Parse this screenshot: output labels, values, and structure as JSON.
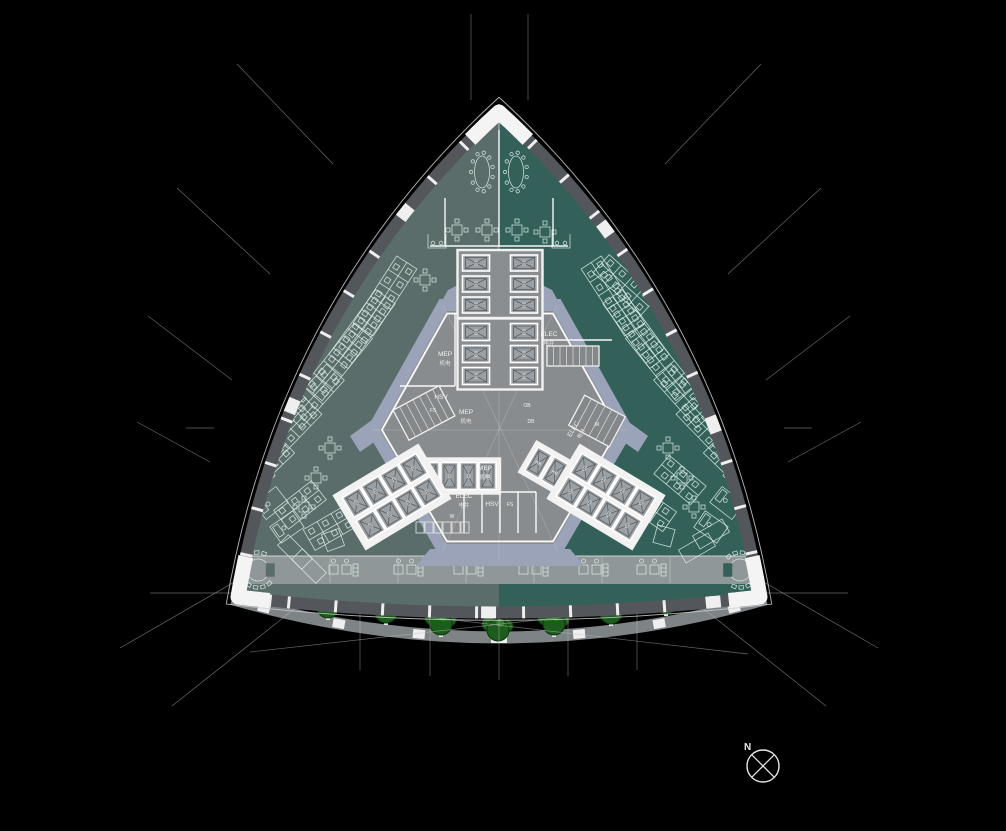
{
  "canvas": {
    "width": 1006,
    "height": 831,
    "background": "#000000"
  },
  "palette": {
    "zone_left": "#5A6D6A",
    "zone_right": "#33615A",
    "bottom_band": "#8F9798",
    "facade_dark": "#53565A",
    "facade_white": "#EFEFEF",
    "outer_line": "#CFCFCF",
    "core_ring": "#9AA3B8",
    "core_fill": "#898C8E",
    "core_wall": "#FFFFFF",
    "shaft_fill": "#9AA0A3",
    "shaft_line": "#5C5F62",
    "furniture_line": "#DFF0EA",
    "hedge_green": "#17500F",
    "tree_fill": "#1C5C1C",
    "tree_edge": "#093609",
    "tree_highlight": "#2E7D2B",
    "walkway_gray": "#7E8486",
    "dim_line": "#BFBFBF"
  },
  "building": {
    "apex": [
      499,
      112
    ],
    "corner_left": [
      238,
      597
    ],
    "corner_right": [
      760,
      597
    ],
    "ctrl_left": [
      288,
      305
    ],
    "ctrl_right": [
      710,
      305
    ],
    "ctrl_bottom": [
      499,
      628
    ],
    "zone_divider_x": 499,
    "bottom_band_y": 556,
    "bottom_band_h": 28
  },
  "core": {
    "hexagon": [
      [
        443,
        305
      ],
      [
        557,
        305
      ],
      [
        627,
        430
      ],
      [
        557,
        550
      ],
      [
        443,
        550
      ],
      [
        373,
        430
      ]
    ],
    "center": [
      500,
      428
    ],
    "ring_extensions": [
      [
        [
          438,
          308
        ],
        [
          460,
          308
        ],
        [
          460,
          284
        ],
        [
          448,
          290
        ]
      ],
      [
        [
          540,
          308
        ],
        [
          562,
          308
        ],
        [
          552,
          290
        ],
        [
          540,
          284
        ]
      ],
      [
        [
          430,
          549
        ],
        [
          570,
          549
        ],
        [
          584,
          566
        ],
        [
          416,
          566
        ]
      ],
      [
        [
          372,
          420
        ],
        [
          380,
          438
        ],
        [
          360,
          452
        ],
        [
          350,
          436
        ]
      ],
      [
        [
          626,
          420
        ],
        [
          618,
          438
        ],
        [
          638,
          452
        ],
        [
          648,
          436
        ]
      ]
    ],
    "labels": [
      {
        "t": "MEP",
        "s": "机电",
        "x": 445,
        "y": 356,
        "rot": 0
      },
      {
        "t": "MEP",
        "s": "机电",
        "x": 466,
        "y": 414,
        "rot": 0
      },
      {
        "t": "MEP",
        "s": "机电",
        "x": 485,
        "y": 470,
        "rot": 0
      },
      {
        "t": "ELEC",
        "s": "电井",
        "x": 549,
        "y": 336,
        "rot": 0
      },
      {
        "t": "ELEC",
        "s": "电井",
        "x": 575,
        "y": 430,
        "rot": -60
      },
      {
        "t": "ELEC",
        "s": "电井",
        "x": 464,
        "y": 498,
        "rot": 0
      },
      {
        "t": "HSV",
        "s": "",
        "x": 441,
        "y": 399,
        "rot": 0
      },
      {
        "t": "FS",
        "s": "",
        "x": 433,
        "y": 412,
        "rot": 0
      },
      {
        "t": "HSV",
        "s": "",
        "x": 492,
        "y": 506,
        "rot": 0
      },
      {
        "t": "FS",
        "s": "",
        "x": 510,
        "y": 506,
        "rot": 0
      },
      {
        "t": "W",
        "s": "",
        "x": 452,
        "y": 518,
        "rot": 0
      },
      {
        "t": "M",
        "s": "",
        "x": 597,
        "y": 426,
        "rot": 0
      },
      {
        "t": "OB",
        "s": "",
        "x": 527,
        "y": 407,
        "rot": 0
      },
      {
        "t": "DB",
        "s": "",
        "x": 531,
        "y": 423,
        "rot": 0
      }
    ],
    "partitions": [
      [
        455,
        314,
        455,
        386
      ],
      [
        400,
        386,
        455,
        386
      ],
      [
        543,
        314,
        543,
        340
      ],
      [
        543,
        340,
        612,
        340
      ],
      [
        448,
        492,
        536,
        492
      ],
      [
        464,
        492,
        464,
        533
      ],
      [
        482,
        492,
        482,
        533
      ],
      [
        500,
        492,
        500,
        533
      ],
      [
        518,
        492,
        518,
        533
      ],
      [
        536,
        492,
        536,
        533
      ],
      [
        499,
        130,
        499,
        246
      ],
      [
        430,
        246,
        568,
        246
      ],
      [
        445,
        198,
        445,
        246
      ],
      [
        553,
        198,
        553,
        246
      ]
    ],
    "toilet_stalls": {
      "x0": 416,
      "y": 522,
      "w": 8,
      "h": 11,
      "step": 9,
      "n": 6
    },
    "stairs": [
      {
        "x": 547,
        "y": 346,
        "w": 52,
        "h": 20,
        "rot": 0,
        "treads": 8
      },
      {
        "x": 398,
        "y": 396,
        "w": 52,
        "h": 34,
        "rot": -28,
        "treads": 7
      },
      {
        "x": 574,
        "y": 404,
        "w": 46,
        "h": 34,
        "rot": 28,
        "treads": 6
      }
    ],
    "construction_lines": [
      [
        373,
        430,
        627,
        430
      ],
      [
        443,
        305,
        557,
        550
      ],
      [
        557,
        305,
        443,
        550
      ],
      [
        499,
        120,
        499,
        560
      ]
    ]
  },
  "elevator_banks": [
    {
      "cx": 500,
      "cy": 284,
      "rot": 0,
      "cols": 2,
      "rows": 3,
      "cw": 27,
      "ch": 16,
      "gx": 21,
      "gy": 5,
      "pad": 5,
      "label": "2C",
      "surround": "#8B8E90"
    },
    {
      "cx": 500,
      "cy": 354,
      "rot": 0,
      "cols": 2,
      "rows": 3,
      "cw": 27,
      "ch": 17,
      "gx": 21,
      "gy": 5,
      "pad": 5,
      "label": "SO",
      "surround": "#8B8E90"
    },
    {
      "cx": 459,
      "cy": 476,
      "rot": 0,
      "cols": 4,
      "rows": 1,
      "cw": 17,
      "ch": 27,
      "gx": 2,
      "gy": 0,
      "pad": 4,
      "label": "24",
      "surround": "#F2F2F2"
    },
    {
      "cx": 563,
      "cy": 477,
      "rot": -60,
      "cols": 1,
      "rows": 4,
      "cw": 27,
      "ch": 16,
      "gx": 0,
      "gy": 3,
      "pad": 4,
      "label": "HB",
      "surround": "#F2F2F2"
    },
    {
      "cx": 392,
      "cy": 497,
      "rot": -31,
      "cols": 4,
      "rows": 2,
      "cw": 20,
      "ch": 23,
      "gx": 2,
      "gy": 4,
      "pad": 6,
      "label": "2C",
      "surround": "#F2F2F2"
    },
    {
      "cx": 606,
      "cy": 497,
      "rot": 31,
      "cols": 4,
      "rows": 2,
      "cw": 20,
      "ch": 23,
      "gx": 2,
      "gy": 4,
      "pad": 6,
      "label": "2D",
      "surround": "#F2F2F2"
    }
  ],
  "furniture": {
    "desk_rows_fields": "[x, y, rotation_deg, n_bays]",
    "desk_rows": [
      [
        385,
        296,
        -57,
        5
      ],
      [
        362,
        329,
        -54,
        5
      ],
      [
        338,
        362,
        -51,
        5
      ],
      [
        314,
        396,
        -48,
        4
      ],
      [
        291,
        429,
        -46,
        4
      ],
      [
        269,
        461,
        -44,
        3
      ],
      [
        300,
        505,
        -38,
        3
      ],
      [
        330,
        528,
        -30,
        3
      ],
      [
        613,
        296,
        57,
        5
      ],
      [
        636,
        329,
        54,
        5
      ],
      [
        660,
        362,
        51,
        5
      ],
      [
        684,
        396,
        48,
        4
      ],
      [
        707,
        429,
        46,
        4
      ],
      [
        729,
        461,
        44,
        3
      ],
      [
        625,
        285,
        42,
        4
      ],
      [
        650,
        508,
        35,
        3
      ],
      [
        680,
        480,
        40,
        3
      ]
    ],
    "square_tables": [
      [
        457,
        230
      ],
      [
        487,
        230
      ],
      [
        517,
        230
      ],
      [
        545,
        232
      ],
      [
        425,
        280
      ],
      [
        330,
        448
      ],
      [
        316,
        478
      ],
      [
        304,
        507
      ],
      [
        668,
        448
      ],
      [
        682,
        478
      ],
      [
        694,
        507
      ]
    ],
    "side_tables": [
      [
        333,
        540,
        -20
      ],
      [
        664,
        536,
        15
      ]
    ],
    "big_tables": [
      [
        295,
        552,
        -45
      ],
      [
        309,
        566,
        -45
      ],
      [
        697,
        548,
        60
      ],
      [
        711,
        534,
        60
      ]
    ],
    "oval_tables": [
      [
        482,
        172
      ],
      [
        516,
        172
      ]
    ],
    "c_tables": [
      {
        "x": 258,
        "y": 570,
        "open": 0,
        "bg": "#5A6D6A"
      },
      {
        "x": 740,
        "y": 570,
        "open": 180,
        "bg": "#33615A"
      }
    ],
    "offices": [
      [
        352,
        213,
        -56
      ],
      [
        371,
        193,
        -58
      ],
      [
        390,
        174,
        -60
      ],
      [
        333,
        234,
        -54
      ],
      [
        316,
        256,
        -52
      ],
      [
        646,
        213,
        56
      ],
      [
        627,
        193,
        58
      ],
      [
        608,
        174,
        60
      ],
      [
        665,
        234,
        54
      ],
      [
        682,
        256,
        52
      ],
      [
        246,
        449,
        -42
      ],
      [
        258,
        477,
        -40
      ],
      [
        271,
        503,
        -38
      ],
      [
        287,
        527,
        -35
      ],
      [
        752,
        449,
        42
      ],
      [
        740,
        477,
        40
      ],
      [
        727,
        503,
        38
      ],
      [
        711,
        527,
        35
      ]
    ],
    "reception_desks": [
      [
        437,
        241
      ],
      [
        561,
        241
      ]
    ],
    "bottom_clusters_x": [
      340,
      405,
      465,
      530,
      590,
      648
    ],
    "bottom_clusters_y": 570
  },
  "landscape": {
    "hedge": {
      "x0": 300,
      "x1": 700,
      "y_top": 583,
      "y_bot": 598
    },
    "trees": [
      [
        328,
        607
      ],
      [
        386,
        612
      ],
      [
        441,
        624
      ],
      [
        498,
        630
      ],
      [
        554,
        624
      ],
      [
        611,
        613
      ],
      [
        666,
        603
      ]
    ],
    "walkway": {
      "p0": [
        232,
        599
      ],
      "ctrl": [
        499,
        676
      ],
      "p1": [
        766,
        599
      ],
      "width": 12,
      "mark_ts": [
        0.06,
        0.2,
        0.35,
        0.5,
        0.65,
        0.8,
        0.94
      ]
    }
  },
  "annotations": {
    "north": {
      "label": "N",
      "cx": 763,
      "cy": 766,
      "r": 16,
      "label_x": 744,
      "label_y": 750
    },
    "dim_lines": [
      [
        471,
        14,
        471,
        100
      ],
      [
        528,
        14,
        528,
        100
      ],
      [
        237,
        64,
        333,
        164
      ],
      [
        177,
        188,
        270,
        274
      ],
      [
        148,
        316,
        232,
        380
      ],
      [
        137,
        422,
        210,
        462
      ],
      [
        761,
        64,
        665,
        164
      ],
      [
        821,
        188,
        728,
        274
      ],
      [
        850,
        316,
        766,
        380
      ],
      [
        861,
        422,
        788,
        462
      ],
      [
        120,
        648,
        262,
        566
      ],
      [
        172,
        706,
        298,
        606
      ],
      [
        878,
        648,
        736,
        566
      ],
      [
        826,
        706,
        700,
        606
      ],
      [
        360,
        598,
        360,
        670
      ],
      [
        430,
        600,
        430,
        676
      ],
      [
        499,
        602,
        499,
        680
      ],
      [
        568,
        600,
        568,
        676
      ],
      [
        637,
        598,
        637,
        670
      ],
      [
        250,
        652,
        752,
        596
      ],
      [
        246,
        596,
        748,
        654
      ],
      [
        150,
        593,
        848,
        593
      ],
      [
        186,
        428,
        214,
        428
      ],
      [
        784,
        428,
        812,
        428
      ]
    ]
  }
}
